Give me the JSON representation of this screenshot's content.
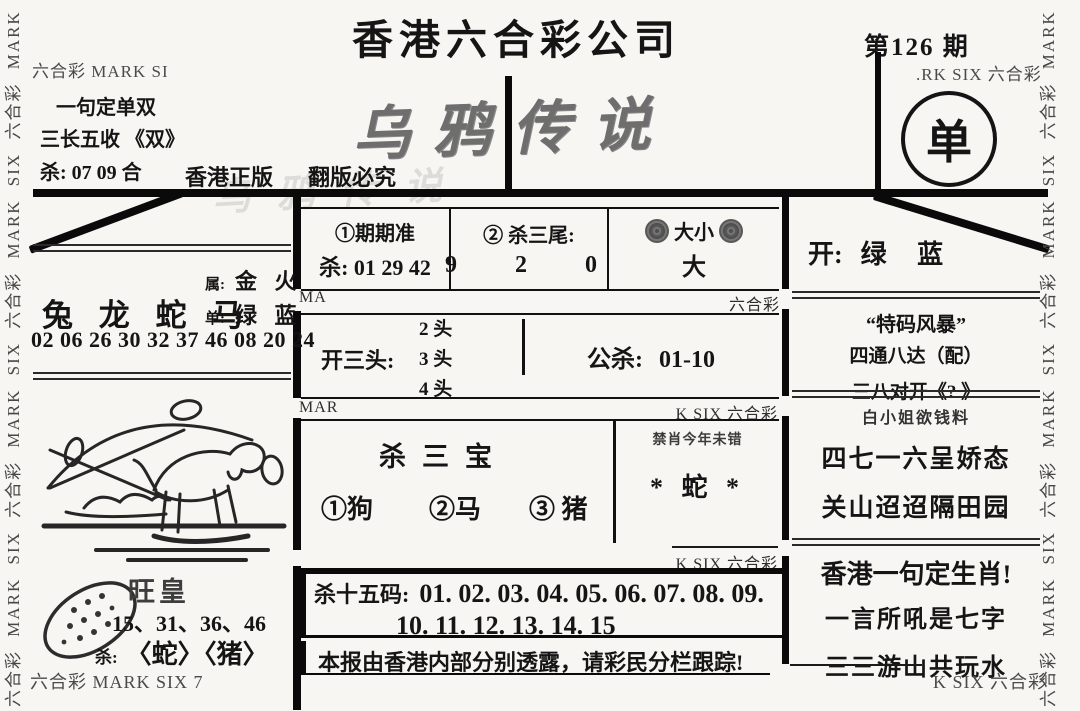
{
  "page": {
    "title": "香港六合彩公司",
    "issue": "第126 期",
    "result_single": "单",
    "stylized_title": "乌鸦传说",
    "edition_left": "香港正版",
    "edition_right": "翻版必究",
    "header_brand_left": "六合彩 MARK SI",
    "header_brand_right": ".RK SIX 六合彩",
    "footer_brand_left": "六合彩 MARK SIX 7",
    "footer_brand_right": "K SIX 六合彩",
    "side_brand": "六合彩 MARK SIX 六合彩 MARK SIX 六合彩 MARK SIX 六合彩 MARK SIX"
  },
  "top_left_box": {
    "line1": "一句定单双",
    "line2": "三长五收 《双》",
    "line3": "杀: 07 09 合"
  },
  "left_column": {
    "attr_label": "属:",
    "attr_value": "金 火",
    "zodiac_main": "兔 龙 蛇 马",
    "single_label": "单:",
    "single_value": "绿 蓝",
    "numbers": "02 06 26 30 32 37 46 08 20 24",
    "wanghuang_title": "旺皇",
    "wanghuang_numbers": "15、31、36、46",
    "wanghuang_kill_label": "杀:",
    "wanghuang_kill_value": "〈蛇〉〈猪〉"
  },
  "center": {
    "box1": {
      "num": "①",
      "title": "期期准",
      "kill": "杀: 01 29 42"
    },
    "box2": {
      "num": "②",
      "title": "杀三尾:",
      "value": "9 2 0"
    },
    "box3": {
      "title": "大小",
      "value": "大"
    },
    "strip1_left": "MA",
    "strip1_right": "六合彩",
    "box4": {
      "label": "开三头:",
      "options": [
        "2 头",
        "3 头",
        "4 头"
      ],
      "right_label": "公杀:",
      "right_value": "01-10"
    },
    "strip2_left": "MAR",
    "strip2_right": "K SIX 六合彩",
    "box5": {
      "title": "杀三宝",
      "item1": "①狗",
      "item2": "②马",
      "item3": "③ 猪",
      "right_note": "禁肖今年未错",
      "right_value": "* 蛇 *"
    },
    "strip3_right": "K SIX 六合彩",
    "box6": {
      "label": "杀十五码:",
      "line1": "01. 02. 03. 04. 05. 06. 07. 08. 09.",
      "line2": "10. 11. 12. 13. 14. 15"
    },
    "footer_note": "本报由香港内部分别透露，请彩民分栏跟踪!"
  },
  "right_column": {
    "open_label": "开:",
    "open_value": "绿 蓝",
    "storm_title": "“特码风暴”",
    "storm_line1": "四通八达（配）",
    "storm_line2": "三八对开《? 》",
    "lady_title": "白小姐欲钱料",
    "lady_line1": "四七一六呈娇态",
    "lady_line2": "关山迢迢隔田园",
    "phrase_title": "香港一句定生肖!",
    "phrase_line1": "一言所吼是七字",
    "phrase_line2": "三三游山共玩水"
  }
}
